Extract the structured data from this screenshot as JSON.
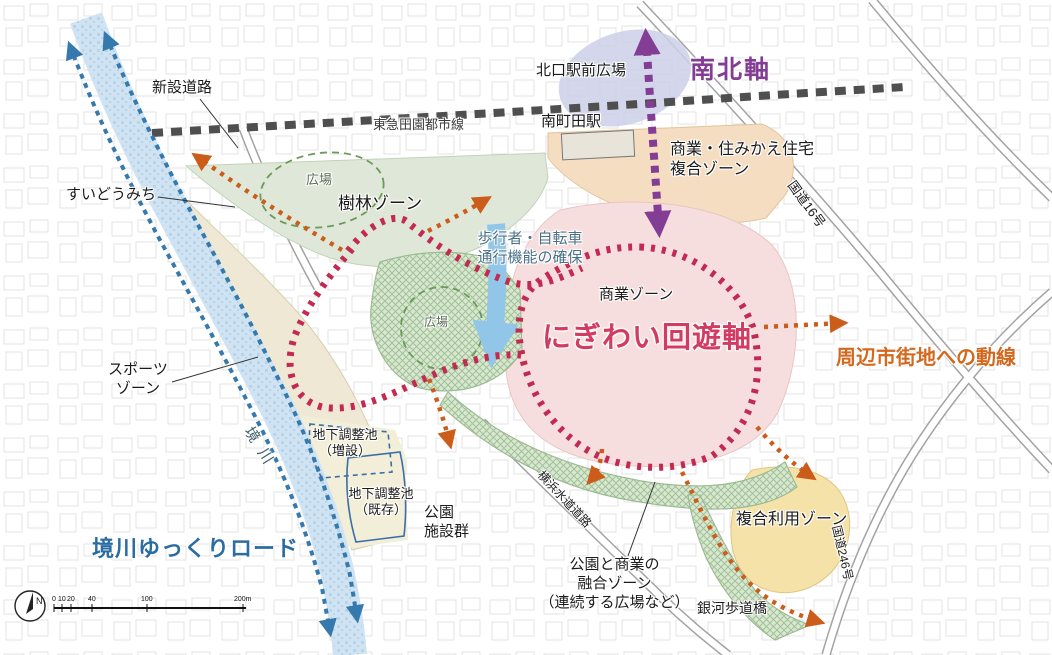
{
  "axes": {
    "north_south": "南北軸",
    "nigiwai": "にぎわい回遊軸",
    "surrounding_flow": "周辺市街地への動線",
    "sakaigawa_slow_road": "境川ゆっくりロード"
  },
  "railway": {
    "line": "東急田園都市線",
    "station": "南町田駅"
  },
  "zones": {
    "jurin": "樹林ゾーン",
    "commercial": "商業ゾーン",
    "sports_line1": "スポーツ",
    "sports_line2": "ゾーン",
    "mixed_line1": "商業・住みかえ住宅",
    "mixed_line2": "複合ゾーン",
    "complex_use": "複合利用ゾーン",
    "fusion_line1": "公園と商業の",
    "fusion_line2": "融合ゾーン",
    "fusion_line3": "（連続する広場など）"
  },
  "features": {
    "station_plaza": "北口駅前広場",
    "new_road": "新設道路",
    "suido_michi": "すいどうみち",
    "plaza_upper": "広場",
    "plaza_lower": "広場",
    "pedestrian_line1": "歩行者・自転車",
    "pedestrian_line2": "通行機能の確保",
    "river": "境川",
    "pond_add_line1": "地下調整池",
    "pond_add_line2": "（増設）",
    "pond_exist_line1": "地下調整池",
    "pond_exist_line2": "（既存）",
    "park_facilities_line1": "公園",
    "park_facilities_line2": "施設群",
    "yokohama_water_road": "横浜水道道路",
    "route16": "国道16号",
    "route246": "国道246号",
    "galaxy_bridge": "銀河歩道橋"
  },
  "compass": {
    "label": "N"
  },
  "scale_bar": {
    "ticks": [
      "0",
      "10",
      "20",
      "40",
      "100",
      "200m"
    ]
  },
  "colors": {
    "nigiwai_red": "#c32a52",
    "axis_purple": "#833d95",
    "flow_orange": "#cc5c1a",
    "route_blue": "#3579ad",
    "rail_gray": "#4f4f4f"
  }
}
